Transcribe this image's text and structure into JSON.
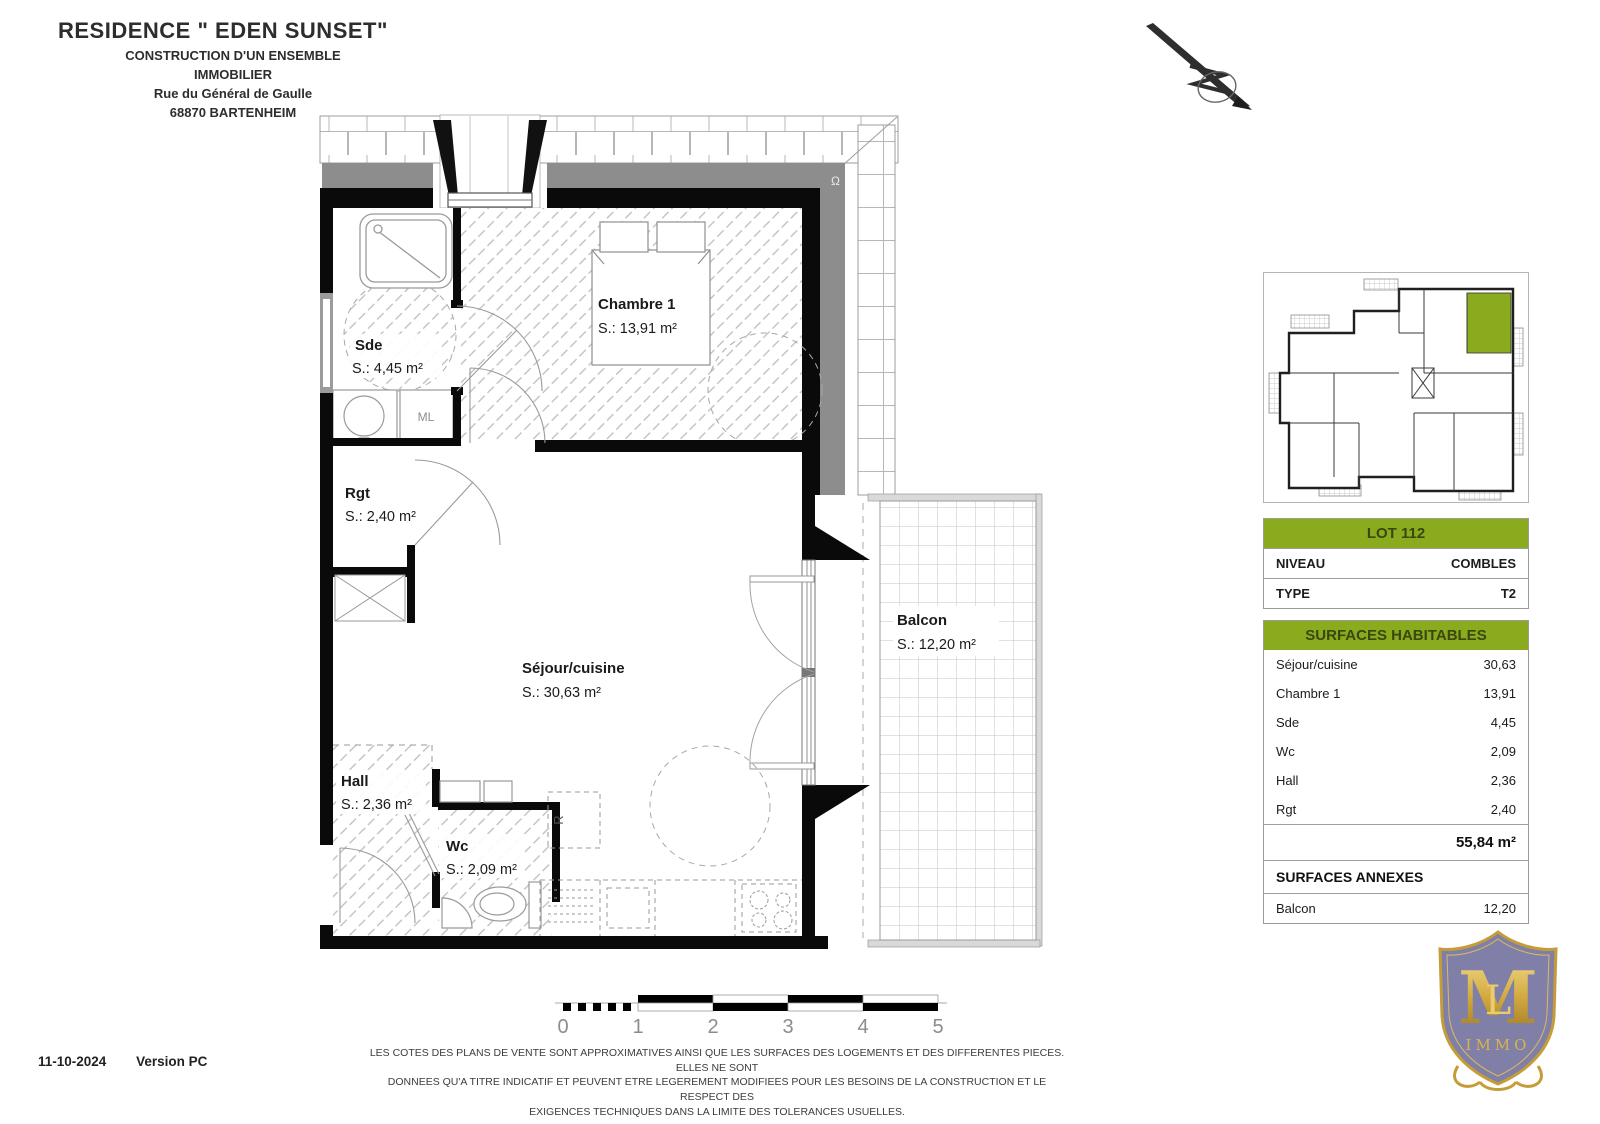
{
  "header": {
    "title": "RESIDENCE \" EDEN SUNSET\"",
    "line1": "CONSTRUCTION D'UN ENSEMBLE",
    "line2": "IMMOBILIER",
    "line3": "Rue du Général de Gaulle",
    "line4": "68870 BARTENHEIM"
  },
  "plan": {
    "rooms": {
      "chambre": {
        "name": "Chambre 1",
        "area": "S.: 13,91 m²"
      },
      "sde": {
        "name": "Sde",
        "area": "S.: 4,45 m²"
      },
      "rgt": {
        "name": "Rgt",
        "area": "S.: 2,40 m²"
      },
      "sejour": {
        "name": "Séjour/cuisine",
        "area": "S.: 30,63 m²"
      },
      "hall": {
        "name": "Hall",
        "area": "S.: 2,36 m²"
      },
      "wc": {
        "name": "Wc",
        "area": "S.: 2,09 m²"
      },
      "balcon": {
        "name": "Balcon",
        "area": "S.: 12,20 m²"
      }
    },
    "appliances": {
      "ml": "ML",
      "fridge": "R"
    }
  },
  "scale_bar": {
    "ticks": [
      "0",
      "1",
      "2",
      "3",
      "4",
      "5"
    ]
  },
  "lot_table": {
    "title": "LOT 112",
    "rows": [
      {
        "label": "NIVEAU",
        "value": "COMBLES"
      },
      {
        "label": "TYPE",
        "value": "T2"
      }
    ]
  },
  "surfaces": {
    "title": "SURFACES HABITABLES",
    "rows": [
      {
        "label": "Séjour/cuisine",
        "value": "30,63"
      },
      {
        "label": "Chambre 1",
        "value": "13,91"
      },
      {
        "label": "Sde",
        "value": "4,45"
      },
      {
        "label": "Wc",
        "value": "2,09"
      },
      {
        "label": "Hall",
        "value": "2,36"
      },
      {
        "label": "Rgt",
        "value": "2,40"
      }
    ],
    "total": "55,84 m²",
    "annexes_title": "SURFACES ANNEXES",
    "annexes_rows": [
      {
        "label": "Balcon",
        "value": "12,20"
      }
    ]
  },
  "footer": {
    "date": "11-10-2024",
    "version": "Version PC",
    "disclaimer1": "LES COTES DES PLANS DE VENTE SONT APPROXIMATIVES AINSI QUE LES SURFACES DES LOGEMENTS ET DES DIFFERENTES PIECES. ELLES NE SONT",
    "disclaimer2": "DONNEES QU'A TITRE INDICATIF ET PEUVENT ETRE LEGEREMENT MODIFIEES POUR LES BESOINS DE LA CONSTRUCTION ET LE RESPECT DES",
    "disclaimer3": "EXIGENCES TECHNIQUES DANS LA LIMITE DES TOLERANCES USUELLES."
  },
  "logo": {
    "monogram": "M",
    "monogram2": "L",
    "sub": "IMMO"
  },
  "colors": {
    "accent_green": "#8aab1e",
    "logo_purple": "#807fa7",
    "logo_gold": "#c59d38"
  }
}
